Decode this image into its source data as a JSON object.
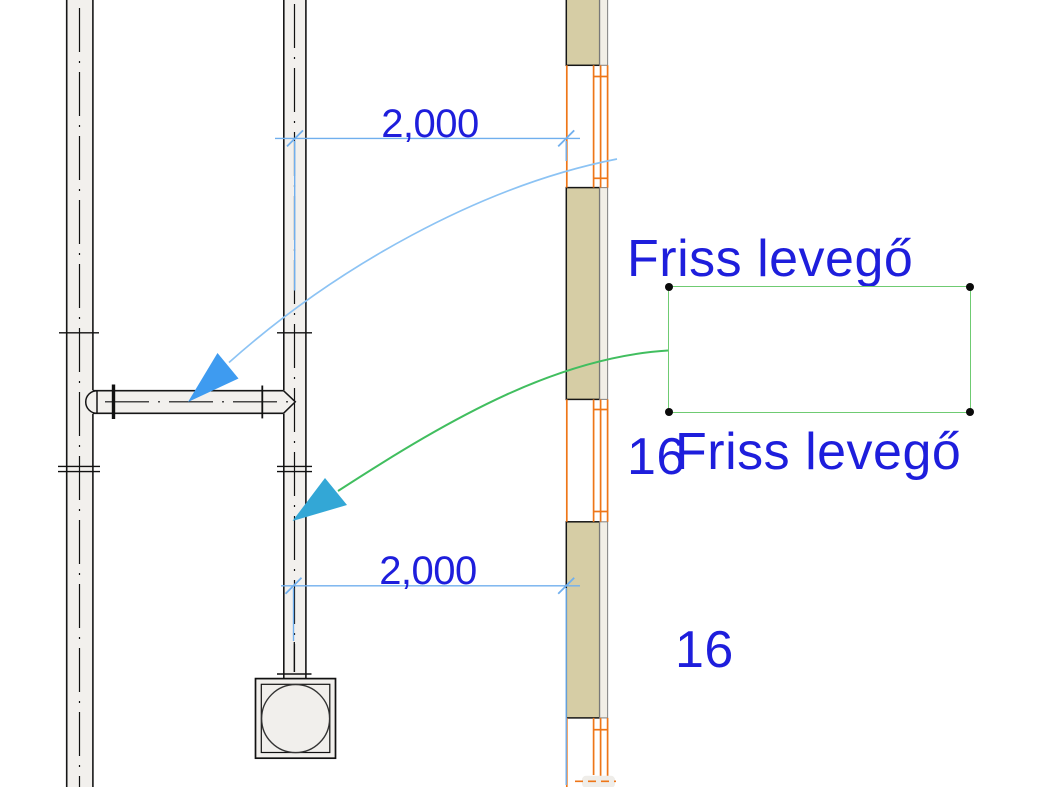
{
  "view": {
    "type": "cad-plan-drawing",
    "background": "#ffffff"
  },
  "annotations": {
    "label_top": {
      "line1": "Friss levegő",
      "line2": "16"
    },
    "label_selected": {
      "line1": "Friss levegő",
      "line2": "16",
      "state": "selected"
    },
    "dimension_top": {
      "value": "2,000"
    },
    "dimension_bottom": {
      "value": "2,000"
    }
  },
  "icons": {
    "leader_arrowhead_top": "filled-triangle-arrowhead pointing down-left",
    "leader_arrowhead_bottom": "filled-triangle-arrowhead pointing down-left",
    "selection_handles": "black corner dots on selected text box"
  },
  "colors": {
    "annotation_text": "#1E1EDC",
    "dimension_lines": "#70AFEE",
    "leader_top": "#8CC3F4",
    "arrowhead_top": "#3E9BF0",
    "leader_bottom": "#41BE5F",
    "arrowhead_bottom": "#33A7D6",
    "selection_box": "#6FCB72",
    "wall_fill": "#D6CDA5",
    "wall_finish_layer": "#F2EFE7",
    "window_frame": "#EE7618",
    "duct_fill": "#F2F0ED",
    "duct_outline": "#161616"
  }
}
